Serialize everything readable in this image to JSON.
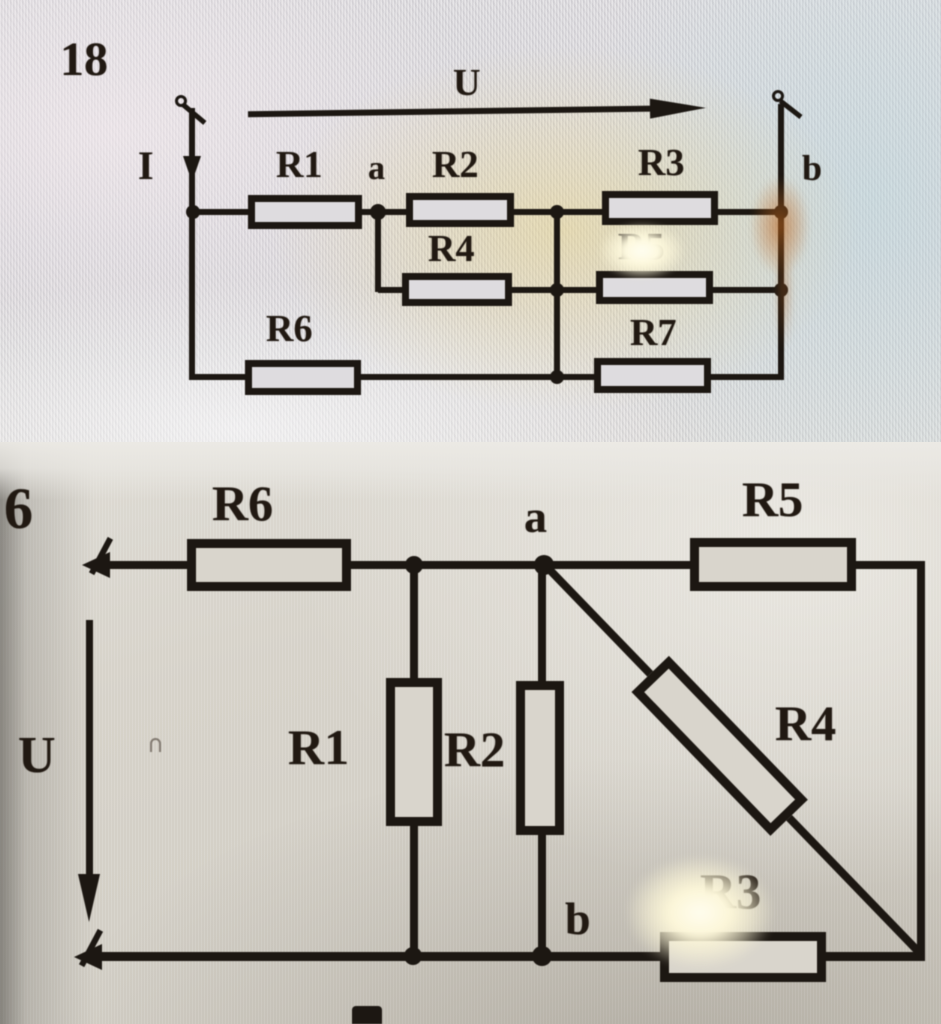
{
  "figure": {
    "kind": "textbook-circuit-diagrams-photo",
    "ink_color": "#1c1712",
    "top_photo_bg": "#d9d7da",
    "bottom_photo_bg": "#d5d1c8",
    "problems": [
      {
        "number": "18",
        "voltage": "U",
        "current": "I",
        "nodes": {
          "a": "a",
          "b": "b"
        },
        "resistors": {
          "r1": "R1",
          "r2": "R2",
          "r3": "R3",
          "r4": "R4",
          "r5": "R5",
          "r6": "R6",
          "r7": "R7"
        }
      },
      {
        "number": "6",
        "voltage": "U",
        "nodes": {
          "a": "a",
          "b": "b"
        },
        "resistors": {
          "r1": "R1",
          "r2": "R2",
          "r3": "R3",
          "r4": "R4",
          "r5": "R5",
          "r6": "R6"
        }
      }
    ]
  }
}
